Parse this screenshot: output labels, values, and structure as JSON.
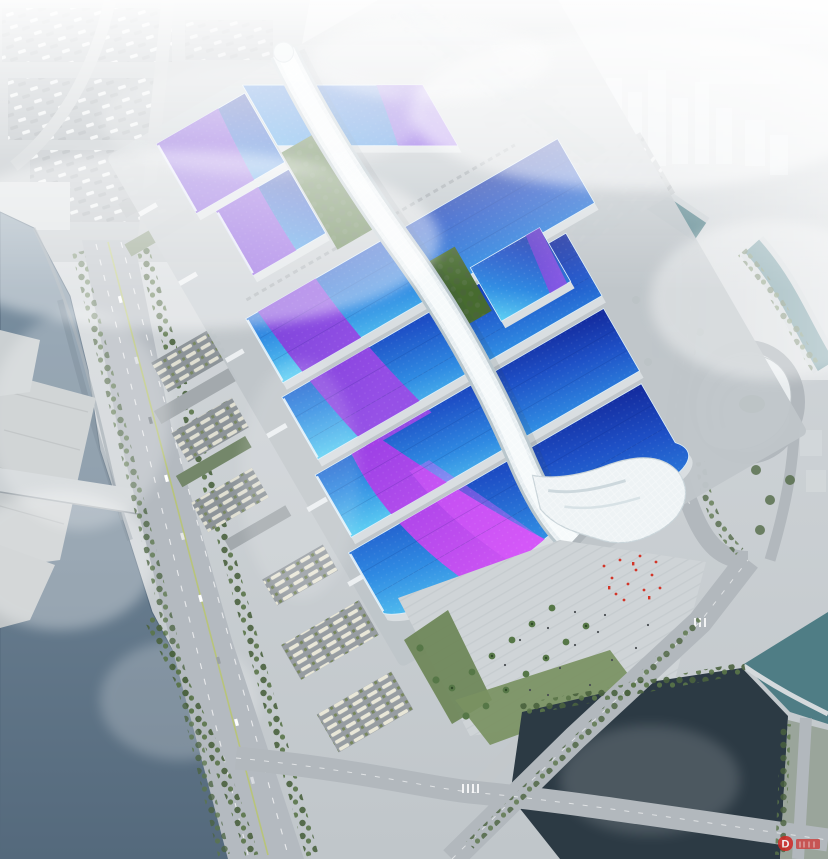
{
  "meta": {
    "title": "Aerial architectural rendering of a riverside exhibition and convention center complex",
    "type": "architectural-rendering",
    "view": "oblique-aerial"
  },
  "watermark": {
    "glyph": "D",
    "color": "#cf2722"
  },
  "palette": {
    "roof_cyan": "#5fd2f4",
    "roof_blue": "#2f8ae2",
    "roof_navy": "#13289b",
    "ribbon_violet": "#6c33cf",
    "ribbon_magenta": "#d64ff4",
    "spine_white": "#f6fafb",
    "shell_white": "#eef3f5",
    "river": "#54697c",
    "pond": "#2c3a44",
    "canal": "#517f88",
    "tree_green": "#4a623e",
    "roof_garden_green": "#476b2f",
    "road_gray": "#b2b8bd",
    "plaza_gray": "#cfd4d7",
    "ground_gray": "#c3c9cd",
    "fog_white": "#f3f6f8",
    "red_accent": "#d23528"
  },
  "scene": {
    "landmarks": [
      {
        "name": "central-pedestrian-spine",
        "desc": "white lattice concourse running the length of the complex"
      },
      {
        "name": "exhibition-hall-bands",
        "desc": "parallel halls with cyan-to-navy roofs and violet-magenta ribbon graphics"
      },
      {
        "name": "south-entrance-shell",
        "desc": "white wave-form canopy over the main entrance"
      },
      {
        "name": "entrance-plaza",
        "desc": "stepped forecourt with palm rows and red banners"
      },
      {
        "name": "riverside-boulevard",
        "desc": "tree-lined arterial road along the west river"
      },
      {
        "name": "west-river",
        "desc": "canal with terraced embankments and road bridges"
      },
      {
        "name": "south-pond",
        "desc": "dark water basin at the lower right"
      },
      {
        "name": "city-skyline",
        "desc": "hazy high-rise district fading into fog"
      }
    ]
  }
}
